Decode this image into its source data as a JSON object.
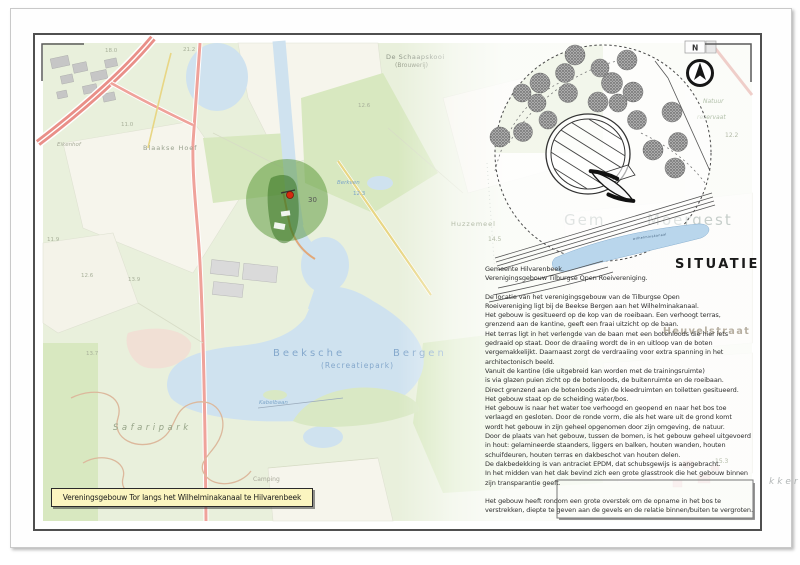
{
  "sheet": {
    "title_box_label": "Vereningsgebouw Tor langs het Wilhelminakanaal te Hilvarenbeek",
    "margin_text": "kker"
  },
  "map": {
    "labels": {
      "schaapskooi": "De Schaapskooi",
      "schaapskooi_sub": "(Brouwerij)",
      "elev_18_0": "18.0",
      "elev_21_2": "21.2",
      "elev_11_0": "11.0",
      "eikenhof": "Eikenhof",
      "blaakse_hoef": "Blaakse Hoef",
      "elev_11_9": "11.9",
      "elev_12_6_left": "12.6",
      "elev_13_9": "13.9",
      "elev_13_7": "13.7",
      "elev_12_6_mid": "12.6",
      "berkven": "Berkven",
      "elev_12_3": "12.3",
      "lock_number": "30",
      "beeksche": "Beeksche",
      "bergen": "Bergen",
      "recreatiepark": "(Recreatiepark)",
      "kabelbaan": "Kabelbaan",
      "safaripark": "Safaripark",
      "camping": "Camping"
    }
  },
  "site_plan": {
    "title": "SITUATIE",
    "compass_label": "N",
    "canal_name": "wilhelminakanaal",
    "faded_map_text_left": "Gem",
    "faded_map_text_right": "Moergest",
    "street": "Heuvelstraat",
    "huzzemeel": "Huzzemeel",
    "elev_14_5": "14.5",
    "natuur": "Natuur",
    "reservaat": "reservaat",
    "elev_12_2": "12.2",
    "elev_15_3": "15.3"
  },
  "text_block": {
    "heading_line1": "Gemeente Hilvarenbeek.",
    "heading_line2": "Verenigingsgebouw Tilburgse Open Roeivereniging.",
    "body_lines": [
      "De locatie van het verenigingsgebouw van de Tilburgse Open",
      "Roeivereniging ligt bij de Beekse Bergen aan het Wilhelminakanaal.",
      "Het gebouw is gesitueerd op de kop van de roeibaan. Een verhoogt terras,",
      "grenzend aan de kantine, geeft een fraai uitzicht op de baan.",
      "Het terras ligt in het verlengde van de baan met een botenloods die hier iets",
      "gedraaid op staat. Door de draaiing wordt de in en uitloop van de boten",
      "vergemakkelijkt. Daarnaast zorgt de verdraaiing voor extra spanning in het",
      "architectonisch beeld.",
      "Vanuit de kantine (die uitgebreid kan worden met de trainingsruimte)",
      "is via glazen puien zicht op de botenloods, de buitenruimte en de roeibaan.",
      "Direct grenzend aan de botenloods zijn de kleedruimten en toiletten gesitueerd.",
      "Het gebouw staat op de scheiding water/bos.",
      "Het gebouw is naar het water toe verhoogd en geopend en naar het bos toe",
      "verlaagd en gesloten. Door de ronde vorm, die als het ware uit de grond komt",
      "wordt het gebouw in zijn geheel opgenomen door zijn omgeving, de natuur.",
      "Door de plaats van het gebouw, tussen de bomen, is het gebouw geheel uitgevoerd",
      "in hout: gelamineerde staanders, liggers en balken, houten wanden, houten",
      "schuifdeuren, houten terras en dakbeschot van houten delen.",
      "De dakbedekking is van antraciet EPDM, dat schubsgewijs is aangebracht.",
      "In het midden van het dak bevind zich een grote glasstrook die het gebouw binnen",
      "zijn transparantie geeft.",
      "",
      "Het gebouw heeft rondom een grote overstek om de opname in het bos te",
      "verstrekken, diepte te geven aan de gevels en de relatie binnen/buiten te vergroten."
    ]
  },
  "colors": {
    "map_background_green": "#e9f0dc",
    "water_blue": "#cfe2ef",
    "highlight_circle_green": "#468C23",
    "location_marker_red": "#d42b10",
    "road_red": "#efa29a",
    "road_yellow": "#e8d684",
    "title_box_yellow": "#fbf5c0"
  }
}
